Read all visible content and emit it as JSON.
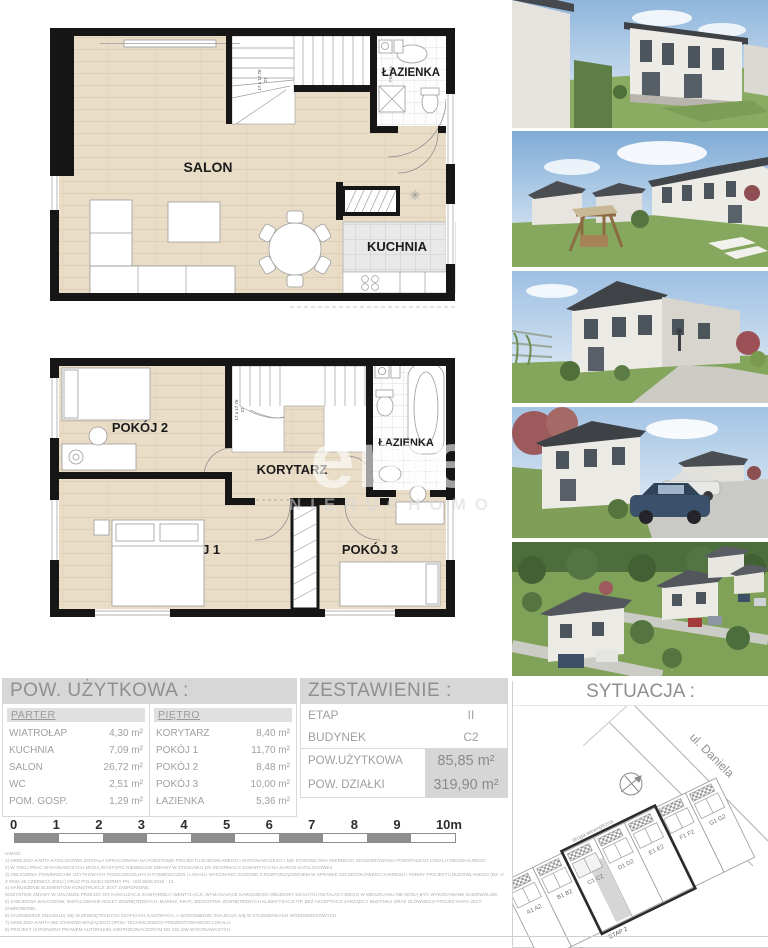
{
  "colors": {
    "wall": "#161616",
    "wood": "#e9ddc8",
    "header_bar": "#d7d7d7",
    "text_gray": "#9a9a9a",
    "highlight_cell": "#d6d6d6"
  },
  "floor1": {
    "salon": "SALON",
    "kuchnia": "KUCHNIA",
    "lazienka": "ŁAZIENKA",
    "stairs_note": "17 x 17,76",
    "stairs_tread": "27",
    "pralka": "PRALKA"
  },
  "floor2": {
    "pokoj1": "POKÓJ 1",
    "pokoj2": "POKÓJ 2",
    "pokoj3": "POKÓJ 3",
    "korytarz": "KORYTARZ",
    "lazienka": "ŁAZIENKA",
    "stairs_note": "17 x 17,76",
    "stairs_tread": "27"
  },
  "watermark": {
    "line1": "eme",
    "line2": "NIERUCHOMO"
  },
  "photos": [
    "house-render-rear-garden",
    "garden-pergola-render",
    "house-front-path-render",
    "street-cars-render",
    "estate-aerial-render"
  ],
  "area_table": {
    "title": "POW. UŻYTKOWA :",
    "parter": {
      "label": "PARTER",
      "rows": [
        {
          "label": "WIATROŁAP",
          "value": "4,30 m²"
        },
        {
          "label": "KUCHNIA",
          "value": "7,09 m²"
        },
        {
          "label": "SALON",
          "value": "26,72 m²"
        },
        {
          "label": "WC",
          "value": "2,51 m²"
        },
        {
          "label": "POM. GOSP.",
          "value": "1,29 m²"
        }
      ]
    },
    "pietro": {
      "label": "PIĘTRO",
      "rows": [
        {
          "label": "KORYTARZ",
          "value": "8,40 m²"
        },
        {
          "label": "POKÓJ 1",
          "value": "11,70 m²"
        },
        {
          "label": "POKÓJ 2",
          "value": "8,48 m²"
        },
        {
          "label": "POKÓJ 3",
          "value": "10,00 m²"
        },
        {
          "label": "ŁAZIENKA",
          "value": "5,36 m²"
        }
      ]
    }
  },
  "summary": {
    "title": "ZESTAWIENIE :",
    "rows": [
      {
        "label": "ETAP",
        "value": "II"
      },
      {
        "label": "BUDYNEK",
        "value": "C2"
      }
    ],
    "area_rows": [
      {
        "label": "POW.UŻYTKOWA",
        "value": "85,85 m²"
      },
      {
        "label": "POW. DZIAŁKI",
        "value": "319,90 m²"
      }
    ]
  },
  "situation": {
    "title": "SYTUACJA :",
    "street": "ul. Daniela",
    "road_label": "droga wewnętrzna",
    "plots": [
      "A1 A2",
      "B1 B2",
      "C1 C2",
      "D1 D2",
      "E1 E2",
      "F1 F2",
      "G1 G2"
    ],
    "etap1": "ETAP 1",
    "etap2": "ETAP 2",
    "highlighted_unit": "C2"
  },
  "scalebar": {
    "ticks": [
      "0",
      "1",
      "2",
      "3",
      "4",
      "5",
      "6",
      "7",
      "8",
      "9",
      "10m"
    ]
  },
  "notes": {
    "header": "UWAGI:",
    "lines": [
      "1) NINIEJSZA KARTA KATALOGOWA ZOSTAŁA OPRACOWANA NA PODSTAWIE PROJEKTU BUDOWLANEGO I WYKONAWCZEGO I NIE STANOWI ONA WIERNEGO ODWZOROWANIA POWSTAŁEGO LOKALU MIESZKALNEGO.",
      "2) W TOKU PRAC WYKONAWCZYCH MOGĄ WYSTĄPIĆ NIEWIELKIE ZMIANY W STOSUNKU DO INFORMACJI ZAWARTYCH NA KARCIE KATALOGOWEJ",
      "3) OBLICZENIA POWIERZCHNI UŻYTKOWYCH POSZCZEGÓLNYCH POMIESZCZEŃ I LOKALU WYKONANO ZGODNIE Z ROZPORZĄDZENIEM W SPRAWIE SZCZEGÓŁOWEGO ZAKRESU I FORMY PROJEKTU BUDOWLANEGO (DZ. U. Z DNIA 25 CZERWCA 2021r.) ORAZ POLSKIEJ NORMY PN - ISO 9836:2015 - 12.",
      "4) NARUSZENIE ELEMENTÓW KONSTRUKCJI JEST ZABRONIONE.",
      "WSZYSTKIE ZMIANY W UKŁADZIE PRZEJŚĆ DO KANALIZACJI SANITARNEJ I WENTYLACJI, WYMAGAJĄCE NARUSZENIA OBUDOWY SZACHTU INSTALACYJNEGO W MIESZKANIU NIE MOGĄ BYĆ WYKONYWANE SAMOWOLNIE.",
      "5) ZABUDOWA BALKONÓW, INSTALOWANIE ROLET ZEWNĘTRZNYCH, MARKIZ, KRAT, JEDNOSTEK ZEWNĘTRZNYCH KLIMATYZACJI ITP. BEZ AKCEPTACJI ZARZĄDCY BUDYNKU ORAZ GŁÓWNEGO PROJEKTANTA JEST ZABRONIONE.",
      "6) GAZOMIERZE ZNAJDUJĄ SIĘ W ZEWNĘTRZNYCH SZAFKACH GAZOWYCH, A WODOMIERZE ZNAJDUJĄ SIĘ W STUDZIENKACH WODOMIERZOWYCH.",
      "7) NINIEJSZA KARTA NIE STANOWI WIĄŻĄCEGO OPISU TECHNICZNEGO PREZENTOWANEGO LOKALU.",
      "8) PROJEKT CHRONIONY PRAWEM AUTORSKIM, NIEPRZEZNACZONYM DO CELÓW WYKONAWCZYCH."
    ]
  }
}
